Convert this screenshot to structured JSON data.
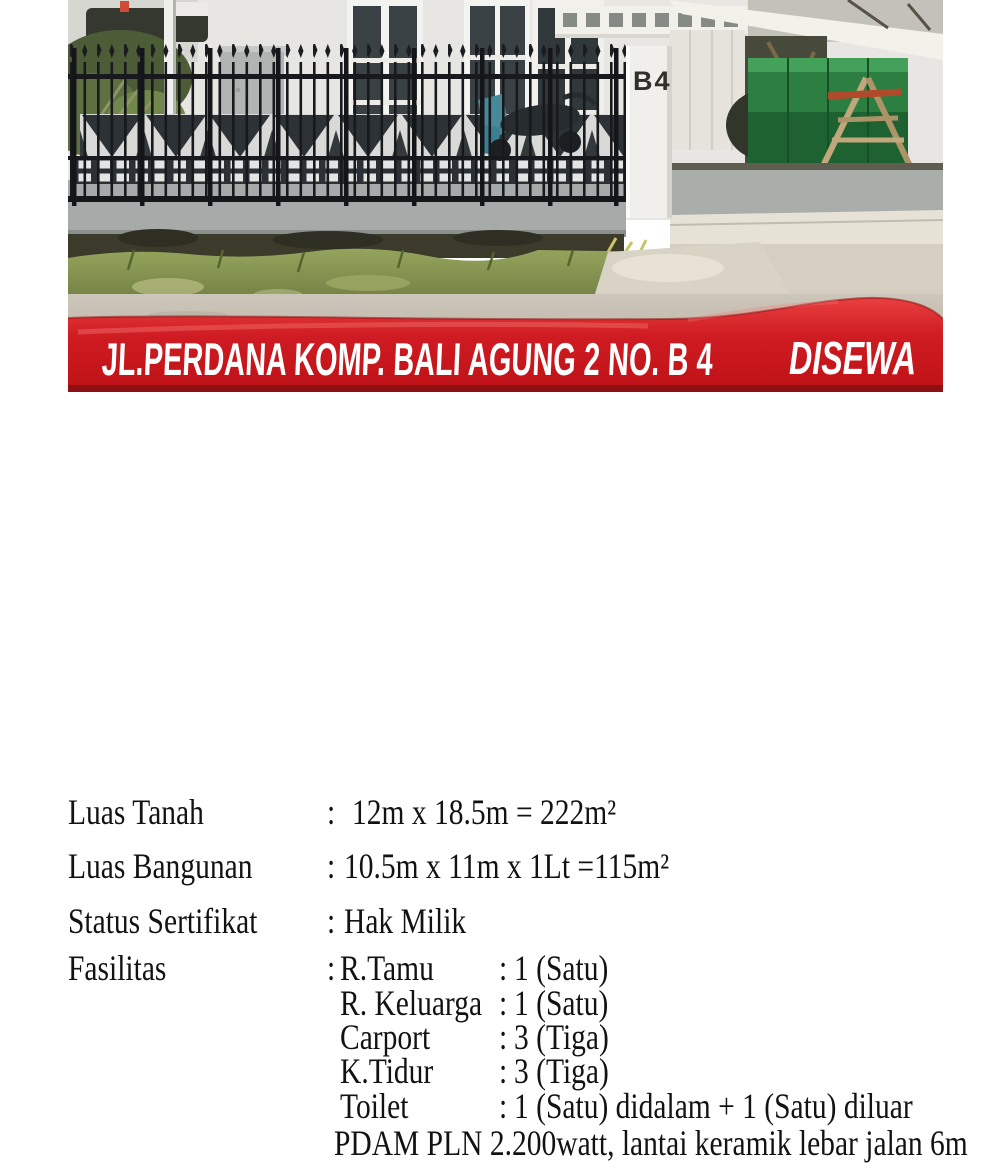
{
  "photo": {
    "house_number": "B4"
  },
  "banner": {
    "address": "JL.PERDANA KOMP. BALI AGUNG 2 NO. B 4",
    "status": "DISEWA",
    "red": "#cf1b22",
    "dark_red": "#8c1014",
    "text_color": "#ffffff"
  },
  "details": {
    "separator": ":",
    "rows": [
      {
        "label": "Luas Tanah",
        "value": "12m x 18.5m = 222m²"
      },
      {
        "label": "Luas Bangunan",
        "value": "10.5m x 11m x 1Lt =115m²"
      },
      {
        "label": "Status Sertifikat",
        "value": "Hak Milik"
      },
      {
        "label": "Fasilitas",
        "value": ""
      }
    ],
    "facilities": [
      {
        "name": "R.Tamu",
        "value": "1 (Satu)"
      },
      {
        "name": "R. Keluarga",
        "value": "1 (Satu)"
      },
      {
        "name": "Carport",
        "value": "3 (Tiga)"
      },
      {
        "name": "K.Tidur",
        "value": "3 (Tiga)"
      },
      {
        "name": "Toilet",
        "value": "1 (Satu) didalam + 1 (Satu) diluar"
      }
    ],
    "footer_note": "PDAM PLN 2.200watt,  lantai keramik lebar jalan 6m"
  }
}
